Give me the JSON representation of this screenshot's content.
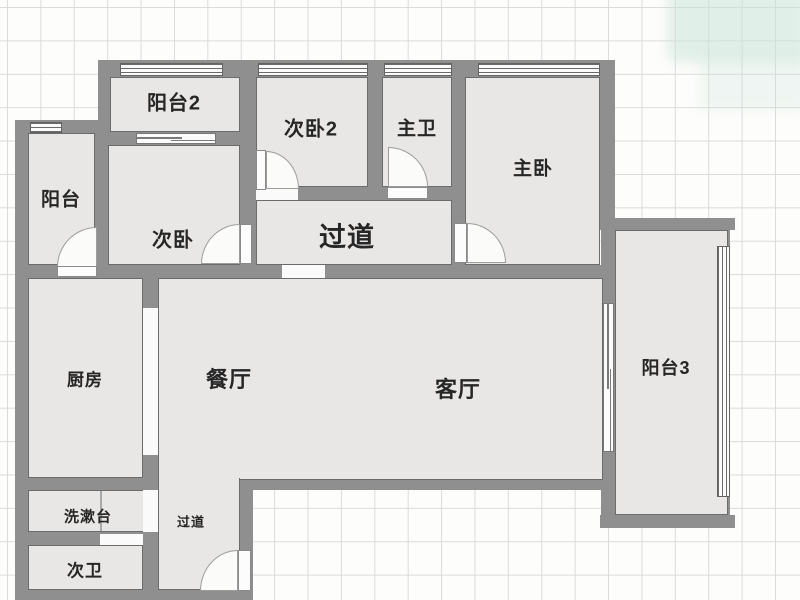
{
  "floorplan": {
    "type": "apartment-floor-plan",
    "colors": {
      "wall": "#8f8f8f",
      "room_fill": "#e8e7e5",
      "room_outline": "#6b6b6b",
      "grid_line": "#dbdbdb",
      "background": "#fdfdfc",
      "window_line": "#6a6a6a",
      "door_arc": "#9c9c9c",
      "text": "#262626",
      "corner_tint": "rgba(202,228,216,0.55)"
    },
    "labels": [
      {
        "name": "label-balcony2",
        "text": "阳台2",
        "x": 174,
        "y": 101,
        "size": 20
      },
      {
        "name": "label-bedroom2",
        "text": "次卧2",
        "x": 311,
        "y": 127,
        "size": 20
      },
      {
        "name": "label-master-bath",
        "text": "主卫",
        "x": 417,
        "y": 127,
        "size": 19
      },
      {
        "name": "label-master-bedroom",
        "text": "主卧",
        "x": 533,
        "y": 167,
        "size": 19
      },
      {
        "name": "label-balcony",
        "text": "阳台",
        "x": 61,
        "y": 198,
        "size": 19
      },
      {
        "name": "label-bedroom",
        "text": "次卧",
        "x": 173,
        "y": 238,
        "size": 20
      },
      {
        "name": "label-hallway",
        "text": "过道",
        "x": 347,
        "y": 235,
        "size": 27
      },
      {
        "name": "label-kitchen",
        "text": "厨房",
        "x": 85,
        "y": 378,
        "size": 17
      },
      {
        "name": "label-dining",
        "text": "餐厅",
        "x": 229,
        "y": 378,
        "size": 22
      },
      {
        "name": "label-living",
        "text": "客厅",
        "x": 458,
        "y": 388,
        "size": 22
      },
      {
        "name": "label-balcony3",
        "text": "阳台3",
        "x": 666,
        "y": 367,
        "size": 18
      },
      {
        "name": "label-washbasin",
        "text": "洗漱台",
        "x": 88,
        "y": 516,
        "size": 15
      },
      {
        "name": "label-corridor",
        "text": "过道",
        "x": 191,
        "y": 521,
        "size": 13
      },
      {
        "name": "label-bath2",
        "text": "次卫",
        "x": 85,
        "y": 569,
        "size": 17
      }
    ],
    "rooms": [
      {
        "name": "room-balcony2",
        "x": 110,
        "y": 77,
        "w": 130,
        "h": 55
      },
      {
        "name": "room-bedroom2",
        "x": 256,
        "y": 77,
        "w": 112,
        "h": 110
      },
      {
        "name": "room-master-bath",
        "x": 382,
        "y": 77,
        "w": 70,
        "h": 110
      },
      {
        "name": "room-master-bedroom",
        "x": 465,
        "y": 77,
        "w": 135,
        "h": 188
      },
      {
        "name": "room-balcony",
        "x": 28,
        "y": 133,
        "w": 67,
        "h": 132
      },
      {
        "name": "room-bedroom",
        "x": 108,
        "y": 145,
        "w": 132,
        "h": 120
      },
      {
        "name": "room-hallway",
        "x": 256,
        "y": 200,
        "w": 196,
        "h": 65
      },
      {
        "name": "room-kitchen",
        "x": 28,
        "y": 278,
        "w": 115,
        "h": 200
      },
      {
        "name": "room-living-dining",
        "x": 158,
        "y": 278,
        "w": 445,
        "h": 202
      },
      {
        "name": "room-balcony3",
        "x": 615,
        "y": 230,
        "w": 113,
        "h": 285
      },
      {
        "name": "room-washbasin",
        "x": 28,
        "y": 490,
        "w": 117,
        "h": 42
      },
      {
        "name": "room-corridor",
        "x": 158,
        "y": 478,
        "w": 82,
        "h": 112
      },
      {
        "name": "room-bath2",
        "x": 28,
        "y": 545,
        "w": 115,
        "h": 45
      }
    ],
    "walls": [
      {
        "name": "wall-top",
        "x": 98,
        "y": 60,
        "w": 517,
        "h": 17
      },
      {
        "name": "wall-balcony2-left",
        "x": 98,
        "y": 60,
        "w": 12,
        "h": 85
      },
      {
        "name": "wall-balcony2-bottom",
        "x": 98,
        "y": 132,
        "w": 158,
        "h": 13
      },
      {
        "name": "wall-left-top",
        "x": 15,
        "y": 120,
        "w": 83,
        "h": 13
      },
      {
        "name": "wall-outer-left",
        "x": 15,
        "y": 120,
        "w": 13,
        "h": 480
      },
      {
        "name": "wall-balcony-bedroom",
        "x": 95,
        "y": 133,
        "w": 13,
        "h": 132
      },
      {
        "name": "wall-mid-vertical",
        "x": 240,
        "y": 60,
        "w": 16,
        "h": 205
      },
      {
        "name": "wall-bedroom2-bath",
        "x": 368,
        "y": 60,
        "w": 14,
        "h": 140
      },
      {
        "name": "wall-bath-master",
        "x": 452,
        "y": 60,
        "w": 15,
        "h": 205
      },
      {
        "name": "wall-master-right",
        "x": 600,
        "y": 60,
        "w": 15,
        "h": 170
      },
      {
        "name": "wall-hallway-top",
        "x": 240,
        "y": 187,
        "w": 227,
        "h": 13
      },
      {
        "name": "wall-main-horizontal",
        "x": 15,
        "y": 265,
        "w": 600,
        "h": 13
      },
      {
        "name": "wall-kitchen-right",
        "x": 143,
        "y": 265,
        "w": 15,
        "h": 335
      },
      {
        "name": "wall-kitchen-bottom",
        "x": 15,
        "y": 478,
        "w": 143,
        "h": 12
      },
      {
        "name": "wall-washbasin-bottom",
        "x": 15,
        "y": 532,
        "w": 143,
        "h": 13
      },
      {
        "name": "wall-bottom",
        "x": 15,
        "y": 590,
        "w": 238,
        "h": 10
      },
      {
        "name": "wall-corridor-right",
        "x": 240,
        "y": 490,
        "w": 13,
        "h": 110
      },
      {
        "name": "wall-living-bottom",
        "x": 237,
        "y": 478,
        "w": 378,
        "h": 12
      },
      {
        "name": "wall-balcony3-top",
        "x": 600,
        "y": 218,
        "w": 135,
        "h": 12
      },
      {
        "name": "wall-balcony3-left",
        "x": 601,
        "y": 218,
        "w": 14,
        "h": 310
      },
      {
        "name": "wall-balcony3-bottom",
        "x": 600,
        "y": 515,
        "w": 135,
        "h": 13
      },
      {
        "name": "wall-balcony3-corner-top",
        "x": 716,
        "y": 230,
        "w": 14,
        "h": 16
      },
      {
        "name": "wall-balcony3-corner-bottom",
        "x": 716,
        "y": 497,
        "w": 14,
        "h": 18
      }
    ],
    "openings": [
      {
        "name": "opening-hallway-dining",
        "x": 282,
        "y": 265,
        "w": 43,
        "h": 13
      },
      {
        "name": "opening-bedroom2-door",
        "x": 256,
        "y": 188,
        "w": 42,
        "h": 12
      },
      {
        "name": "opening-kitchen-passage",
        "x": 143,
        "y": 308,
        "w": 15,
        "h": 147
      },
      {
        "name": "opening-kitchen-washbasin",
        "x": 143,
        "y": 490,
        "w": 15,
        "h": 42
      },
      {
        "name": "opening-washbasin-bath",
        "x": 100,
        "y": 534,
        "w": 43,
        "h": 11
      }
    ],
    "patches": [
      {
        "name": "patch-dining-corridor",
        "x": 159,
        "y": 477,
        "w": 80,
        "h": 3
      }
    ],
    "windows": [
      {
        "name": "window-balcony2",
        "x": 120,
        "y": 63,
        "w": 103,
        "h": 13,
        "dir": "h"
      },
      {
        "name": "window-bedroom2",
        "x": 258,
        "y": 63,
        "w": 110,
        "h": 13,
        "dir": "h"
      },
      {
        "name": "window-master-bath",
        "x": 384,
        "y": 63,
        "w": 68,
        "h": 13,
        "dir": "h"
      },
      {
        "name": "window-master-bedroom",
        "x": 478,
        "y": 63,
        "w": 122,
        "h": 13,
        "dir": "h"
      },
      {
        "name": "window-balcony-top",
        "x": 30,
        "y": 122,
        "w": 32,
        "h": 11,
        "dir": "h"
      },
      {
        "name": "window-balcony3-right",
        "x": 717,
        "y": 246,
        "w": 13,
        "h": 251,
        "dir": "v"
      }
    ],
    "sliders": [
      {
        "name": "slider-balcony2-bedroom",
        "x": 136,
        "y": 133,
        "w": 80,
        "h": 11,
        "dir": "h"
      },
      {
        "name": "slider-living-balcony3",
        "x": 603,
        "y": 303,
        "w": 11,
        "h": 149,
        "dir": "v"
      }
    ],
    "doors": [
      {
        "name": "door-balcony-kitchen",
        "arc": {
          "x": 57,
          "y": 227,
          "w": 40,
          "h": 40,
          "corner": "tl"
        },
        "leaf": {
          "x": 57,
          "y": 266,
          "w": 40,
          "h": 11
        }
      },
      {
        "name": "door-bedroom",
        "arc": {
          "x": 201,
          "y": 224,
          "w": 39,
          "h": 40,
          "corner": "tl"
        },
        "leaf": {
          "x": 240,
          "y": 224,
          "w": 12,
          "h": 40
        }
      },
      {
        "name": "door-bedroom2",
        "arc": {
          "x": 266,
          "y": 151,
          "w": 33,
          "h": 38,
          "corner": "tr"
        },
        "leaf": {
          "x": 256,
          "y": 150,
          "w": 10,
          "h": 40
        }
      },
      {
        "name": "door-master-bath",
        "arc": {
          "x": 388,
          "y": 147,
          "w": 40,
          "h": 40,
          "corner": "tr"
        },
        "leaf": {
          "x": 387,
          "y": 187,
          "w": 41,
          "h": 12
        }
      },
      {
        "name": "door-master-bedroom",
        "arc": {
          "x": 467,
          "y": 223,
          "w": 39,
          "h": 40,
          "corner": "tr"
        },
        "leaf": {
          "x": 454,
          "y": 223,
          "w": 13,
          "h": 40
        }
      },
      {
        "name": "door-entry",
        "arc": {
          "x": 200,
          "y": 550,
          "w": 38,
          "h": 41,
          "corner": "tl"
        },
        "leaf": {
          "x": 238,
          "y": 550,
          "w": 13,
          "h": 41
        }
      }
    ],
    "lines": [
      {
        "name": "washbasin-divider",
        "x": 100,
        "y": 491,
        "w": 2,
        "h": 40
      }
    ],
    "tints": [
      {
        "name": "corner-tint-strong",
        "x": 668,
        "y": -10,
        "w": 140,
        "h": 72,
        "color": "rgba(202,228,216,0.55)"
      },
      {
        "name": "corner-tint-soft",
        "x": 700,
        "y": 55,
        "w": 110,
        "h": 55,
        "color": "rgba(202,228,216,0.28)"
      }
    ]
  }
}
